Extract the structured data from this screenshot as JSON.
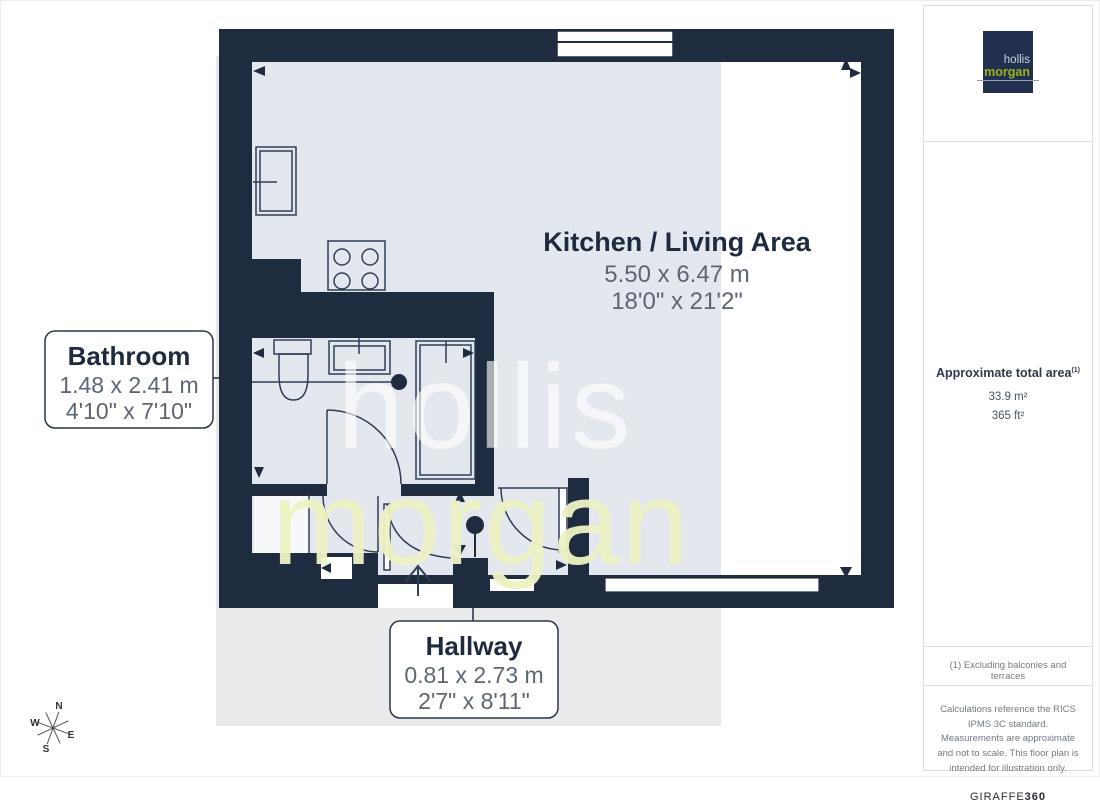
{
  "floor_plan": {
    "rooms": {
      "kitchen_living": {
        "name": "Kitchen / Living Area",
        "metric": "5.50 x 6.47 m",
        "imperial": "18'0\" x 21'2\""
      },
      "bathroom": {
        "name": "Bathroom",
        "metric": "1.48 x 2.41 m",
        "imperial": "4'10\" x 7'10\""
      },
      "hallway": {
        "name": "Hallway",
        "metric": "0.81 x 2.73 m",
        "imperial": "2'7\" x 8'11\""
      }
    },
    "watermark": {
      "line1": "hollis",
      "line2": "morgan"
    },
    "compass": {
      "north": "N",
      "east": "E",
      "south": "S",
      "west": "W"
    }
  },
  "sidebar": {
    "logo": {
      "line1": "hollis",
      "line2": "morgan"
    },
    "area_summary": {
      "title": "Approximate total area",
      "footnote_marker": "(1)",
      "metric": "33.9 m²",
      "imperial": "365 ft²"
    },
    "footnote": "(1) Excluding balconies and terraces",
    "disclaimer": "Calculations reference the RICS IPMS 3C standard. Measurements are approximate and not to scale. This floor plan is intended for illustration only.",
    "brand": {
      "name": "GIRAFFE",
      "suffix": "360"
    }
  },
  "colors": {
    "wall_navy": "#1f2c40",
    "floor_blue_grey": "#e3e8ee",
    "backdrop_grey": "#e9eaeb",
    "logo_navy": "#22304f",
    "logo_green": "#9cb31e",
    "watermark_green": "#eef3c4",
    "dim_text": "#5c6674"
  }
}
